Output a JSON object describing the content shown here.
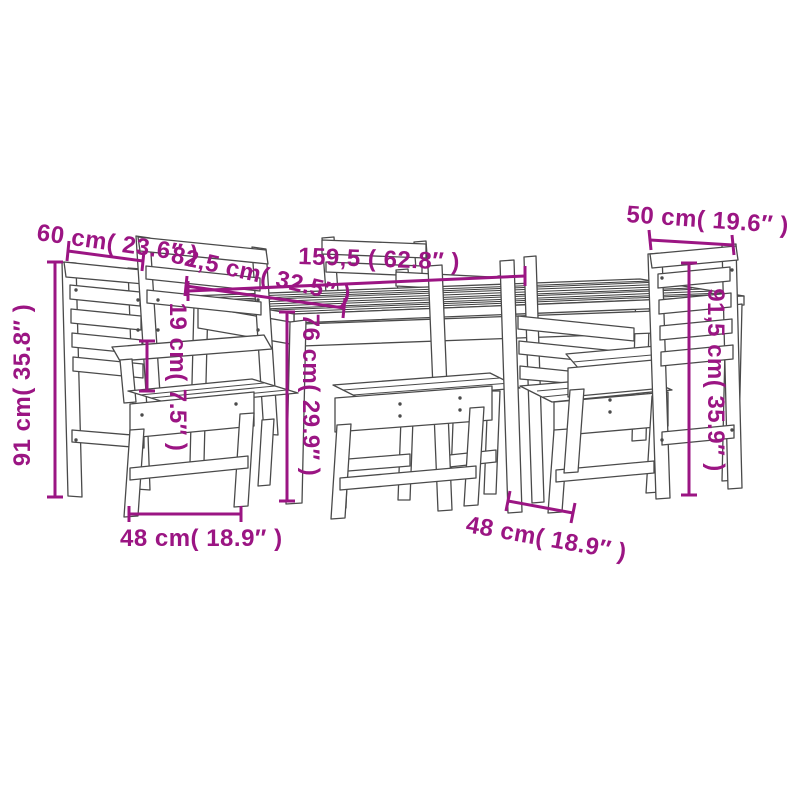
{
  "diagram": {
    "type": "product-dimension-drawing",
    "subject": "garden dining set: table with six slatted wooden chairs",
    "background_color": "#FFFFFF",
    "accent_color": "#9B1583",
    "line_color": "#4A4A4A",
    "dimensions": {
      "left_chair_back_width": "60 cm( 23.6″ )",
      "table_depth": "82,5 cm( 32.5″ )",
      "table_length": "159,5 ( 62.8″ )",
      "right_chair_back_width": "50 cm( 19.6″ )",
      "left_chair_height": "91 cm( 35.8″ )",
      "armrest_to_seat_height": "19 cm( 7.5″ )",
      "table_height": "76 cm( 29.9″ )",
      "right_chair_height": "91,5 cm( 35.9″ )",
      "front_left_chair_width": "48 cm( 18.9″ )",
      "front_right_chair_depth": "48 cm( 18.9″ )"
    }
  }
}
